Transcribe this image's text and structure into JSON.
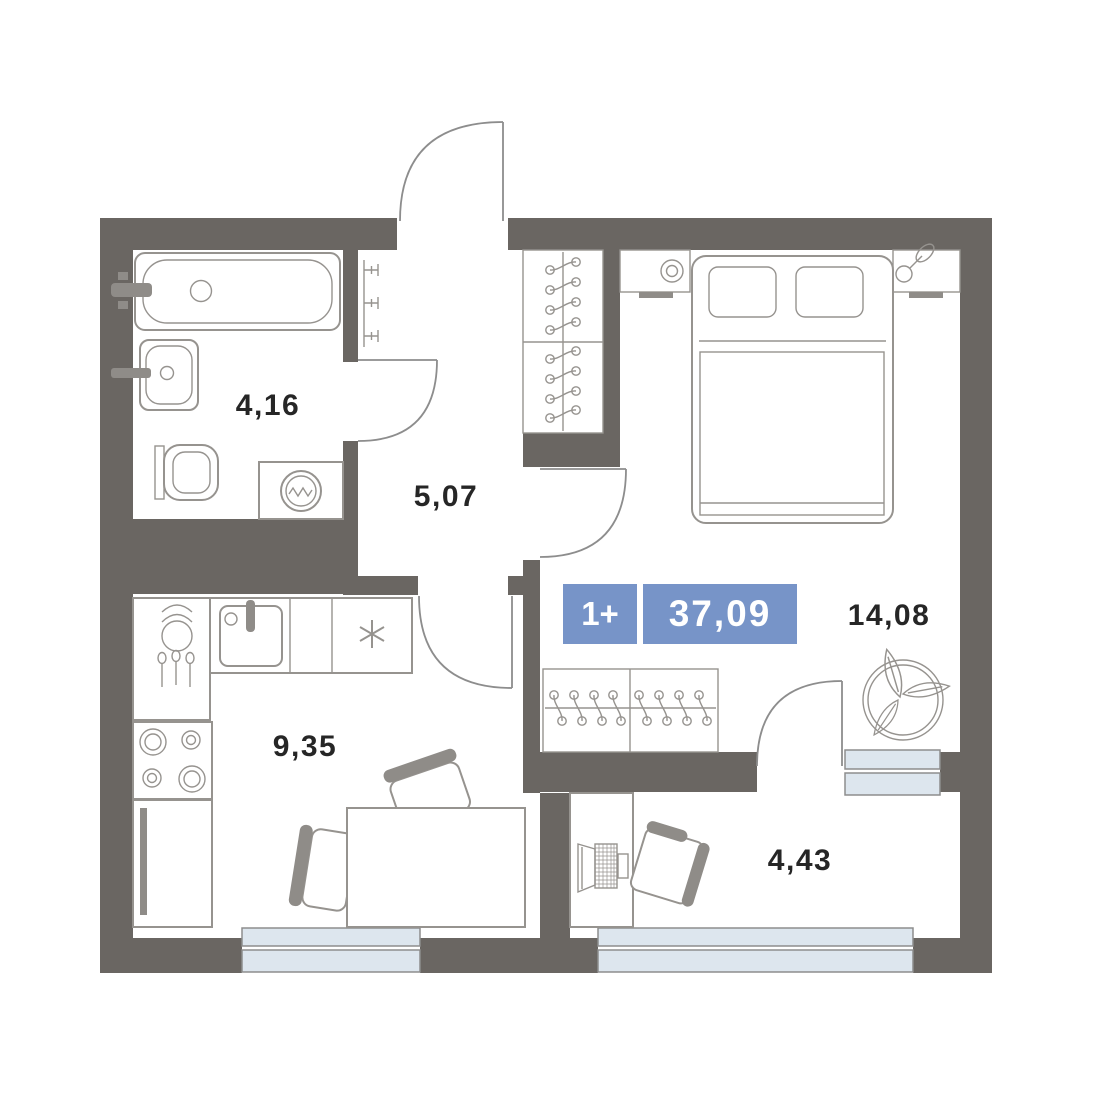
{
  "plan": {
    "title": "1-room apartment floor plan",
    "type_badge": {
      "rooms_label": "1+",
      "total_area": "37,09"
    },
    "rooms": [
      {
        "id": "bathroom",
        "area": "4,16"
      },
      {
        "id": "hallway",
        "area": "5,07"
      },
      {
        "id": "kitchen",
        "area": "9,35"
      },
      {
        "id": "bedroom",
        "area": "14,08"
      },
      {
        "id": "balcony",
        "area": "4,43"
      }
    ],
    "icons": [
      "bathtub-icon",
      "bath-sink-icon",
      "toilet-icon",
      "washing-machine-icon",
      "towel-radiator-icon",
      "entrance-door-icon",
      "bathroom-door-icon",
      "bedroom-door-icon",
      "kitchen-door-icon",
      "balcony-door-icon",
      "wardrobe-hangers-icon",
      "bed-icon",
      "pillow-icon",
      "lamp-icon",
      "plant-sprig-icon",
      "plant-pot-icon",
      "kitchen-sink-icon",
      "faucet-icon",
      "dishes-icon",
      "cutlery-icon",
      "cooktop-asterisk-icon",
      "stove-icon",
      "fridge-icon",
      "dining-table-icon",
      "chair-icon",
      "desk-icon",
      "laptop-icon",
      "window-icon"
    ],
    "colors": {
      "wall": "#6a6662",
      "line": "#96938f",
      "accent": "#8f8c88",
      "door": "#8d8d8d",
      "winfill": "#dde6ee",
      "labeltext": "#262626",
      "badge": "#7794c8",
      "badgetext": "#ffffff",
      "background": "#ffffff"
    }
  }
}
